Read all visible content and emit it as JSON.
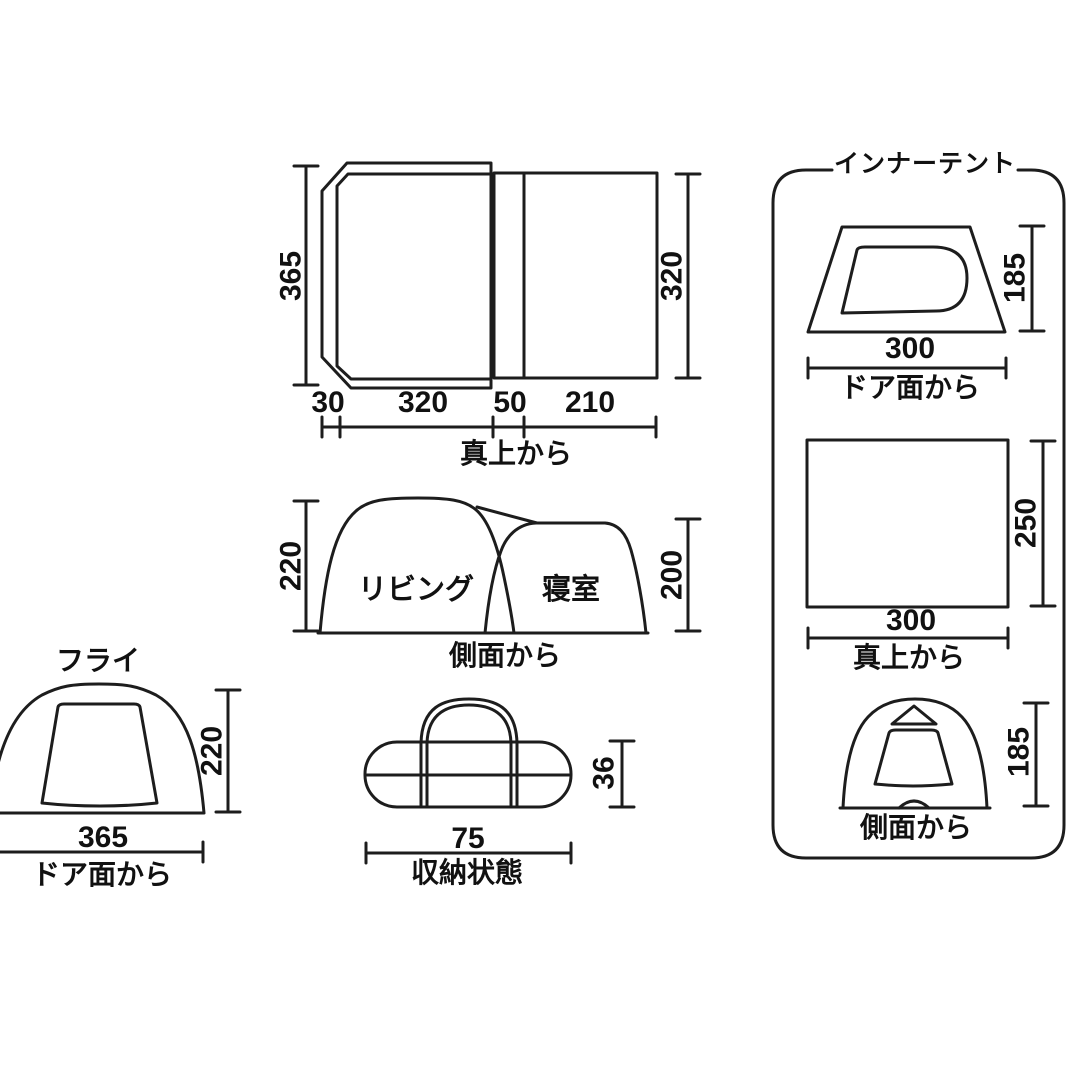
{
  "colors": {
    "line": "#1d1d1d",
    "text": "#111111",
    "background": "#ffffff"
  },
  "top_view": {
    "label": "真上から",
    "dim_depth_left": "365",
    "dim_depth_right": "320",
    "dim_widths": {
      "porch": "30",
      "living": "320",
      "gap": "50",
      "bedroom": "210"
    }
  },
  "side_view": {
    "label": "側面から",
    "room_living": "リビング",
    "room_bedroom": "寝室",
    "dim_height_left": "220",
    "dim_height_right": "200"
  },
  "fly_view": {
    "title": "フライ",
    "label": "ドア面から",
    "dim_height": "220",
    "dim_width": "365"
  },
  "storage_view": {
    "label": "収納状態",
    "dim_width": "75",
    "dim_height": "36"
  },
  "inner_tent": {
    "title": "インナーテント",
    "door_view": {
      "label": "ドア面から",
      "dim_width": "300",
      "dim_height": "185"
    },
    "top_view": {
      "label": "真上から",
      "dim_width": "300",
      "dim_height": "250"
    },
    "side_view": {
      "label": "側面から",
      "dim_height": "185"
    }
  }
}
